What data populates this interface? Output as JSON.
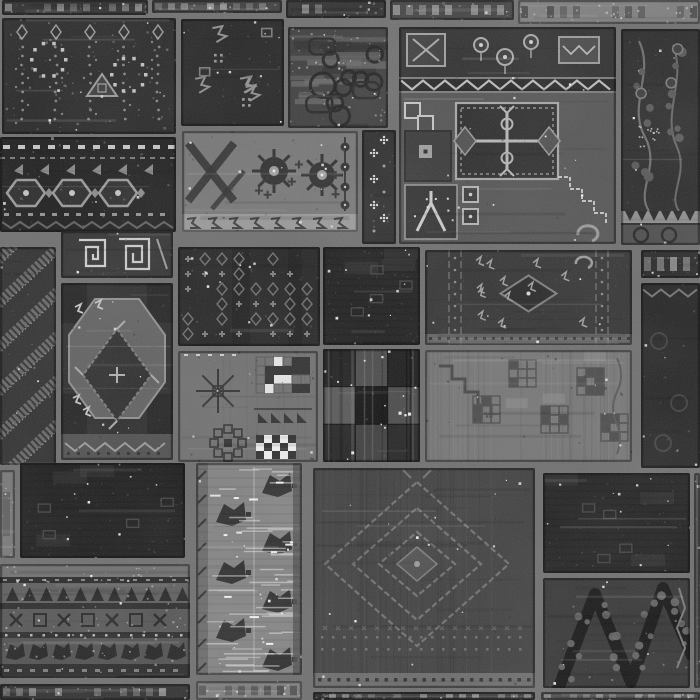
{
  "image": {
    "kind": "grayscale-photograph",
    "subject": "patchwork rug of stitched vintage carpet fragments",
    "canvas": {
      "width": 700,
      "height": 700
    },
    "seam_color": "#6e6e6e",
    "palette": {
      "darkest": "#141414",
      "dark": "#262626",
      "mid": "#4a4a4a",
      "light": "#7a7a7a",
      "lightest": "#a8a8a8",
      "glint": "#ffffff"
    },
    "grain": {
      "fine_opacity": 0.15,
      "cloud_opacity": 0.09
    }
  },
  "patches": [
    {
      "name": "top-strip-1",
      "style": "strip",
      "x": 2,
      "y": 0,
      "w": 146,
      "h": 15,
      "base": "#2b2b2b"
    },
    {
      "name": "top-strip-2",
      "style": "strip",
      "x": 152,
      "y": 0,
      "w": 130,
      "h": 13,
      "base": "#3c3c3c"
    },
    {
      "name": "top-strip-3",
      "style": "strip",
      "x": 286,
      "y": 0,
      "w": 100,
      "h": 18,
      "base": "#2e2e2e"
    },
    {
      "name": "top-strip-4",
      "style": "strip",
      "x": 390,
      "y": 0,
      "w": 124,
      "h": 20,
      "base": "#424242"
    },
    {
      "name": "top-strip-5",
      "style": "strip",
      "x": 518,
      "y": 0,
      "w": 182,
      "h": 24,
      "base": "#7d7d7d"
    },
    {
      "name": "floral-field",
      "style": "floralField",
      "x": 2,
      "y": 18,
      "w": 174,
      "h": 116,
      "base": "#272727"
    },
    {
      "name": "kazak-border",
      "style": "borderBand",
      "x": 0,
      "y": 137,
      "w": 176,
      "h": 95,
      "base": "#1d1d1d"
    },
    {
      "name": "sparse-dark",
      "style": "sparseDark",
      "x": 181,
      "y": 19,
      "w": 103,
      "h": 107,
      "base": "#242424"
    },
    {
      "name": "mottled-scroll",
      "style": "mottled",
      "x": 288,
      "y": 27,
      "w": 100,
      "h": 101,
      "base": "#3d3d3d"
    },
    {
      "name": "arabesque-border",
      "style": "arabesqueLight",
      "x": 182,
      "y": 131,
      "w": 176,
      "h": 101,
      "base": "#767676"
    },
    {
      "name": "star-strip",
      "style": "starStrip",
      "x": 362,
      "y": 130,
      "w": 34,
      "h": 114,
      "base": "#2c2c2c"
    },
    {
      "name": "stepped-medallion",
      "style": "medallion",
      "x": 399,
      "y": 27,
      "w": 217,
      "h": 217,
      "base": "#545454"
    },
    {
      "name": "vine-floral",
      "style": "vineDark",
      "x": 621,
      "y": 29,
      "w": 79,
      "h": 216,
      "base": "#2a2a2a"
    },
    {
      "name": "diagonal-zigzag",
      "style": "diagZigzag",
      "x": 0,
      "y": 247,
      "w": 56,
      "h": 218,
      "base": "#2e2e2e"
    },
    {
      "name": "spiral-squares",
      "style": "spiralSq",
      "x": 61,
      "y": 231,
      "w": 112,
      "h": 47,
      "base": "#323232"
    },
    {
      "name": "octagon-gul",
      "style": "octagon",
      "x": 61,
      "y": 283,
      "w": 112,
      "h": 177,
      "base": "#2c2c2c"
    },
    {
      "name": "dense-rows",
      "style": "denseRows",
      "x": 178,
      "y": 247,
      "w": 142,
      "h": 99,
      "base": "#242424"
    },
    {
      "name": "pixel-sampler",
      "style": "sampler",
      "x": 178,
      "y": 351,
      "w": 140,
      "h": 111,
      "base": "#6f6f6f"
    },
    {
      "name": "dark-fragment",
      "style": "plainDark",
      "x": 323,
      "y": 247,
      "w": 97,
      "h": 98,
      "base": "#1e1e1e"
    },
    {
      "name": "checker-squares",
      "style": "checker",
      "x": 323,
      "y": 349,
      "w": 97,
      "h": 113,
      "base": "#222222"
    },
    {
      "name": "afshar-stripes",
      "style": "afshar",
      "x": 425,
      "y": 250,
      "w": 207,
      "h": 95,
      "base": "#333333"
    },
    {
      "name": "weathered-grid",
      "style": "weathered",
      "x": 425,
      "y": 350,
      "w": 207,
      "h": 112,
      "base": "#757575"
    },
    {
      "name": "right-strip",
      "style": "strip",
      "x": 641,
      "y": 250,
      "w": 59,
      "h": 28,
      "base": "#282828"
    },
    {
      "name": "zigzag-edge-dark",
      "style": "zigzagTopDark",
      "x": 641,
      "y": 283,
      "w": 59,
      "h": 185,
      "base": "#242424"
    },
    {
      "name": "left-sliver",
      "style": "strip",
      "x": 0,
      "y": 470,
      "w": 15,
      "h": 88,
      "base": "#767676"
    },
    {
      "name": "plain-black",
      "style": "plainDark",
      "x": 20,
      "y": 463,
      "w": 165,
      "h": 95,
      "base": "#1b1b1b"
    },
    {
      "name": "banded-stripes",
      "style": "bandedStripes",
      "x": 0,
      "y": 564,
      "w": 190,
      "h": 114,
      "base": "#575757"
    },
    {
      "name": "weathered-white",
      "style": "weatheredWhite",
      "x": 196,
      "y": 463,
      "w": 106,
      "h": 212,
      "base": "#828282"
    },
    {
      "name": "diamond-field",
      "style": "diamondField",
      "x": 313,
      "y": 468,
      "w": 222,
      "h": 220,
      "base": "#3f3f3f"
    },
    {
      "name": "plain-dark-right",
      "style": "plainDark",
      "x": 543,
      "y": 473,
      "w": 147,
      "h": 100,
      "base": "#202020"
    },
    {
      "name": "branch-diagonals",
      "style": "branches",
      "x": 543,
      "y": 578,
      "w": 147,
      "h": 110,
      "base": "#353535"
    },
    {
      "name": "right-sliver",
      "style": "strip",
      "x": 694,
      "y": 473,
      "w": 6,
      "h": 215,
      "base": "#565656"
    },
    {
      "name": "bottom-strip-1",
      "style": "strip",
      "x": 0,
      "y": 684,
      "w": 190,
      "h": 16,
      "base": "#2f2f2f"
    },
    {
      "name": "bottom-strip-2",
      "style": "strip",
      "x": 196,
      "y": 681,
      "w": 106,
      "h": 19,
      "base": "#7f7f7f"
    },
    {
      "name": "bottom-strip-3",
      "style": "strip",
      "x": 313,
      "y": 692,
      "w": 222,
      "h": 8,
      "base": "#262626"
    },
    {
      "name": "bottom-strip-4",
      "style": "strip",
      "x": 541,
      "y": 692,
      "w": 159,
      "h": 8,
      "base": "#4b4b4b"
    }
  ]
}
